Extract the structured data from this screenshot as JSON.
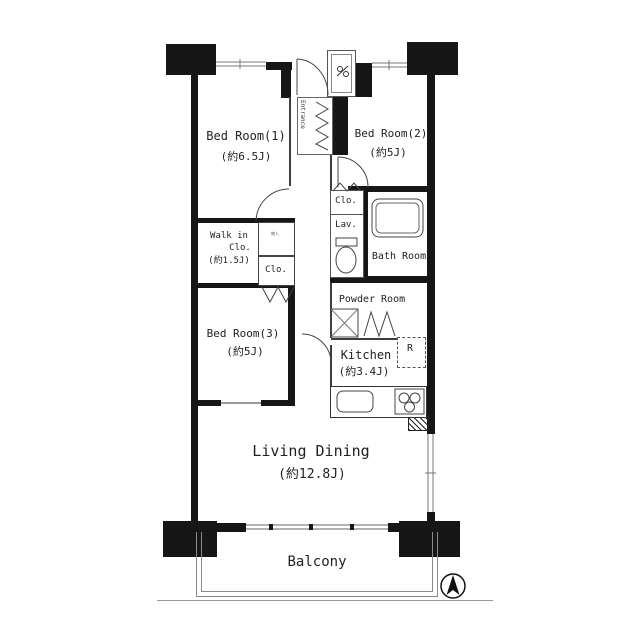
{
  "rooms": {
    "bedroom1": {
      "label": "Bed Room(1)",
      "size": "(約6.5J)"
    },
    "bedroom2": {
      "label": "Bed Room(2)",
      "size": "(約5J)"
    },
    "bedroom3": {
      "label": "Bed Room(3)",
      "size": "(約5J)"
    },
    "walkin_closet": {
      "line1": "Walk in",
      "line2": "Clo.",
      "size": "(約1.5J)"
    },
    "living_dining": {
      "label": "Living Dining",
      "size": "(約12.8J)"
    },
    "kitchen": {
      "label": "Kitchen",
      "size": "(約3.4J)"
    },
    "bath": {
      "label": "Bath Room"
    },
    "powder": {
      "label": "Powder Room"
    },
    "lavatory": {
      "label": "Lav."
    },
    "hall_closet": {
      "label": "Clo."
    },
    "bedroom3_closet": {
      "label": "Clo."
    },
    "entrance": {
      "label": "Entrance"
    },
    "storage": {
      "label": "物入"
    },
    "balcony": {
      "label": "Balcony"
    }
  },
  "fixtures": {
    "refrigerator_label": "R"
  },
  "colors": {
    "wall": "#161616",
    "partition": "#3d3d3d",
    "fixture_line": "#444444",
    "text": "#222222",
    "background": "#ffffff"
  }
}
